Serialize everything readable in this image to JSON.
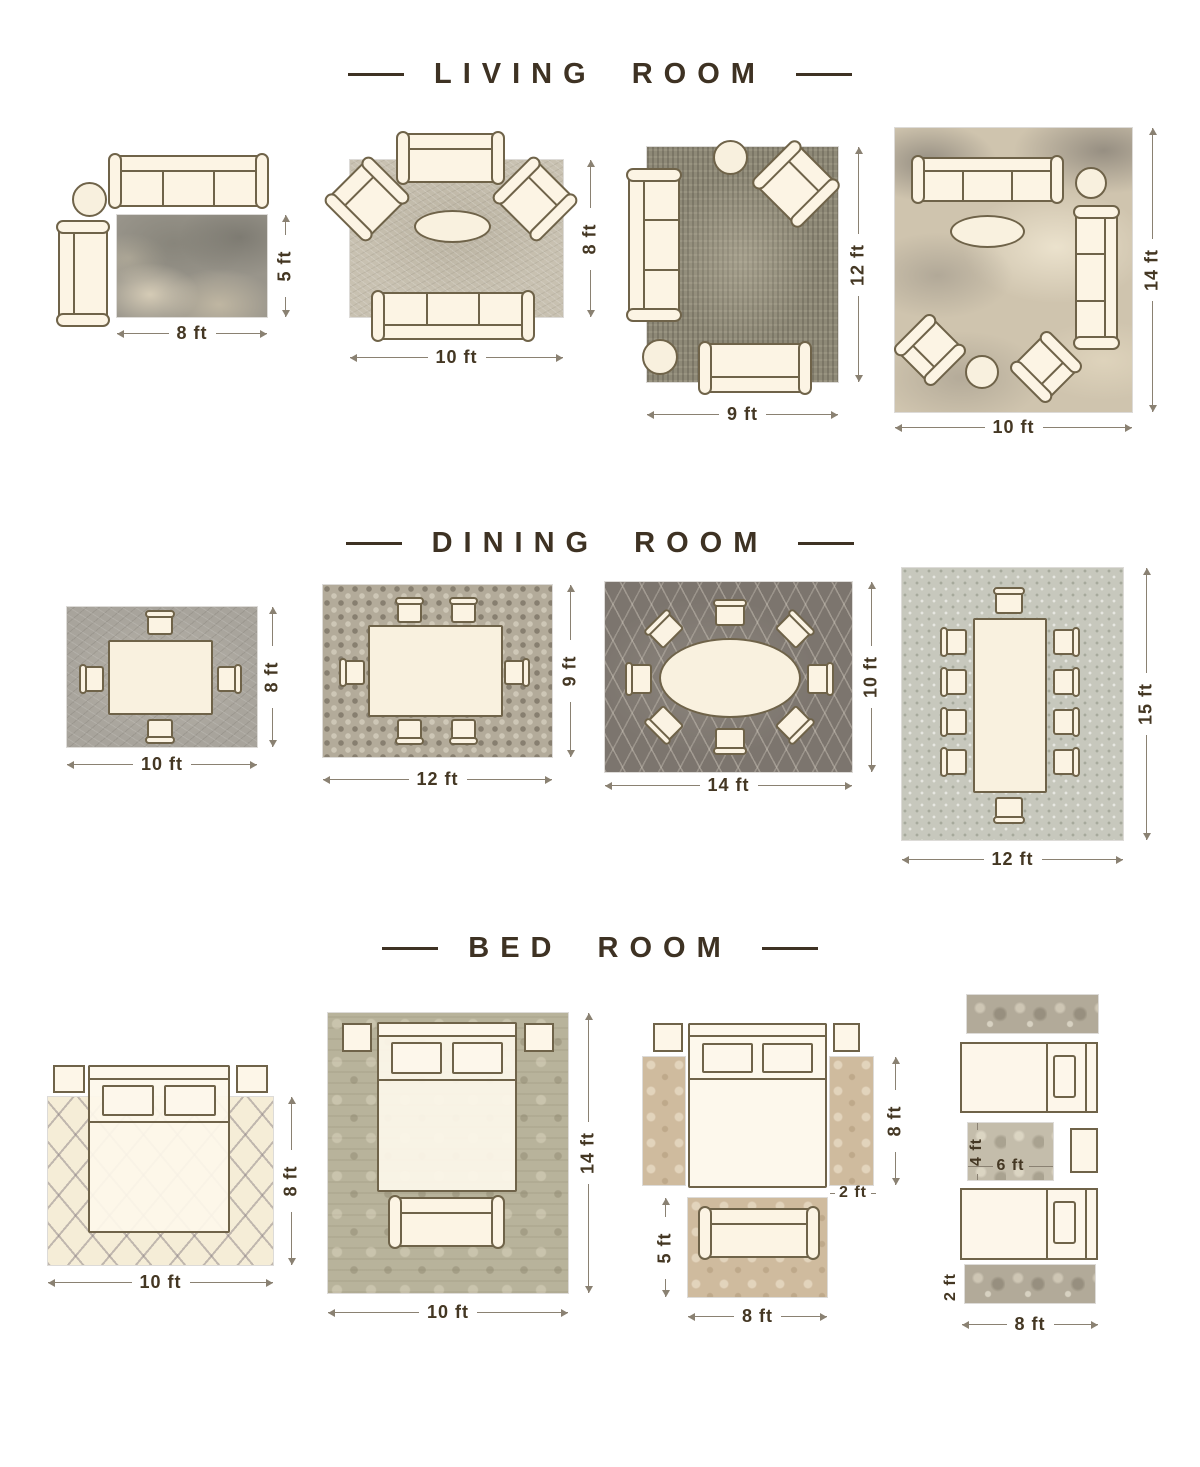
{
  "colors": {
    "background": "#ffffff",
    "ink": "#3e3223",
    "dimension_line": "#8a8172",
    "furniture_fill": "#fbf3e3",
    "furniture_outline": "#6f6349"
  },
  "sections": {
    "living": {
      "title": "LIVING ROOM",
      "layouts": [
        {
          "w": "8 ft",
          "h": "5 ft"
        },
        {
          "w": "10 ft",
          "h": "8 ft"
        },
        {
          "w": "9 ft",
          "h": "12 ft"
        },
        {
          "w": "10 ft",
          "h": "14 ft"
        }
      ]
    },
    "dining": {
      "title": "DINING ROOM",
      "layouts": [
        {
          "w": "10 ft",
          "h": "8 ft"
        },
        {
          "w": "12 ft",
          "h": "9 ft"
        },
        {
          "w": "14 ft",
          "h": "10 ft"
        },
        {
          "w": "12 ft",
          "h": "15 ft"
        }
      ]
    },
    "bedroom": {
      "title": "BED ROOM",
      "layouts": [
        {
          "w": "10 ft",
          "h": "8 ft"
        },
        {
          "w": "10 ft",
          "h": "14 ft"
        },
        {
          "bed_side": "8 ft",
          "runner_w": "2 ft",
          "foot_rug_h": "5 ft",
          "foot_rug_w": "8 ft"
        },
        {
          "mid_rug_h": "4 ft",
          "mid_rug_w": "6 ft",
          "runner_h": "2 ft",
          "runner_w": "8 ft"
        }
      ]
    }
  }
}
